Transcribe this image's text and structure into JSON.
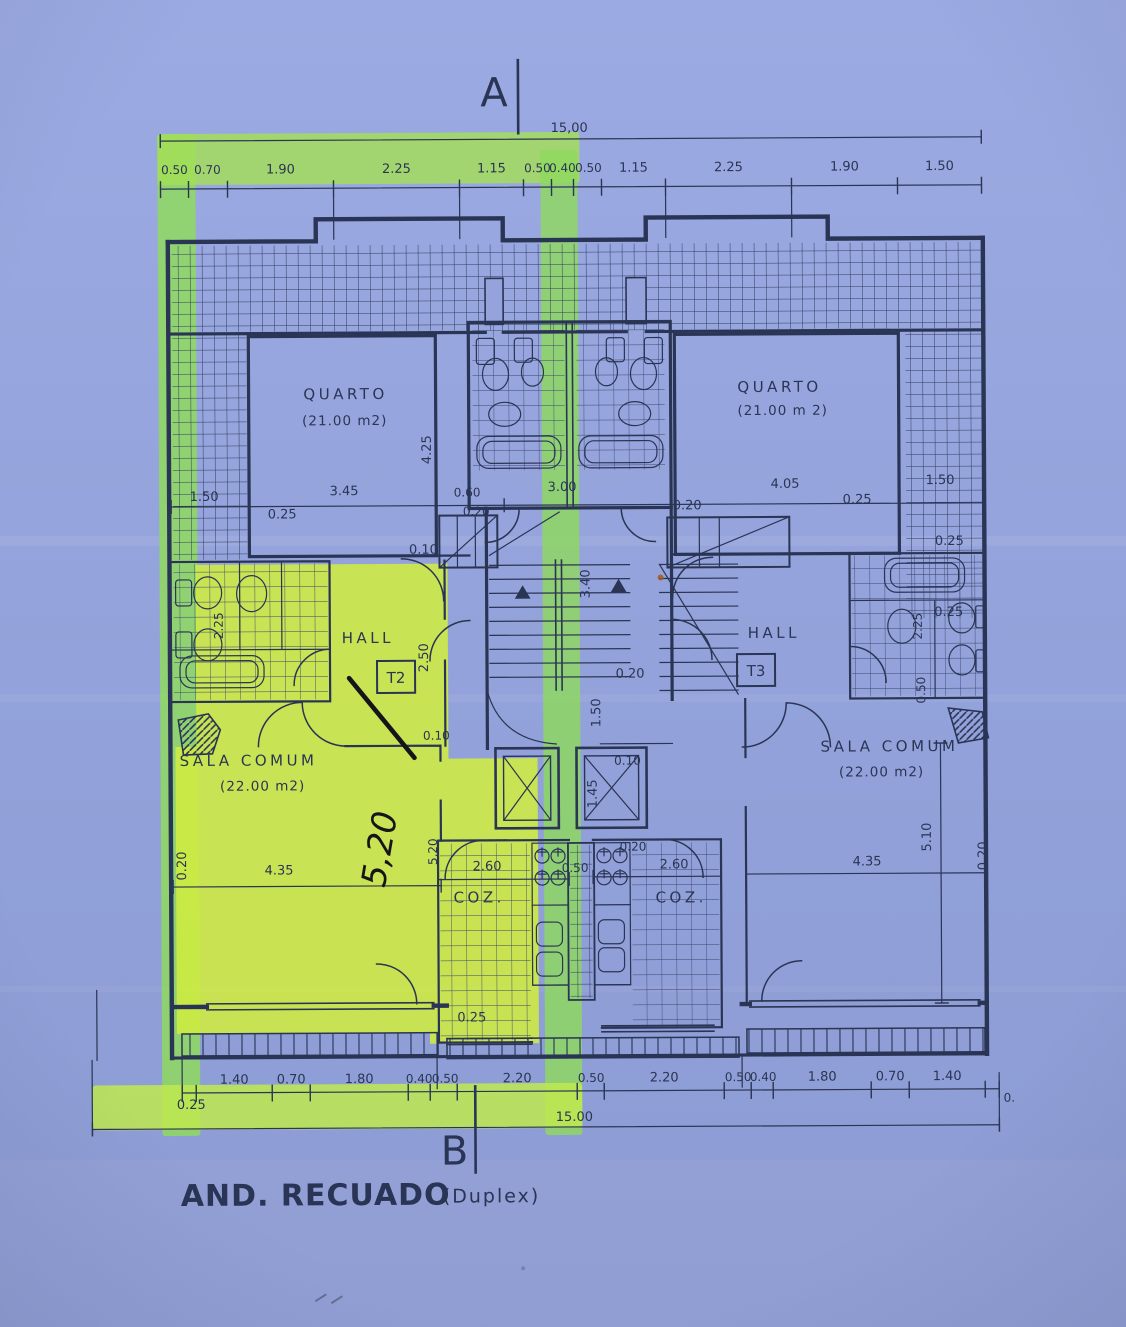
{
  "colors": {
    "paper": "#94a3dc",
    "ink": "#2a3454",
    "pen_black": "#15141b",
    "highlighter_green": "#8fd95e",
    "highlighter_yellow": "#cfec40"
  },
  "markers": {
    "top": "A",
    "bottom": "B"
  },
  "title": {
    "main": "AND. RECUADO",
    "sub": "(Duplex)"
  },
  "overall_dim": {
    "top": "15,00",
    "bottom": "15.00"
  },
  "handwriting": {
    "note": "5,20"
  },
  "rooms": {
    "quarto_left": {
      "name": "QUARTO",
      "area": "(21.00 m2)"
    },
    "quarto_right": {
      "name": "QUARTO",
      "area": "(21.00 m 2)"
    },
    "hall_left": {
      "name": "HALL",
      "tag": "T2"
    },
    "hall_right": {
      "name": "HALL",
      "tag": "T3"
    },
    "sala_left": {
      "name": "SALA COMUM",
      "area": "(22.00 m2)"
    },
    "sala_right": {
      "name": "SALA COMUM",
      "area": "(22.00 m2)"
    },
    "coz_left": {
      "name": "COZ."
    },
    "coz_right": {
      "name": "COZ."
    }
  },
  "dims_top": [
    "0.50",
    "0.70",
    "1.90",
    "2.25",
    "1.15",
    "0.50",
    "0.40",
    "0.50",
    "1.15",
    "2.25",
    "1.90",
    "1.50"
  ],
  "dims_bottom": [
    "1.40",
    "0.70",
    "1.80",
    "0.40",
    "0.50",
    "2.20",
    "0.50",
    "2.20",
    "0.50",
    "0.40",
    "1.80",
    "0.70",
    "1.40"
  ],
  "dims_bottom_left": "0.25",
  "dims_bottom_right": "0.",
  "dims_plan": [
    "1.50",
    "3.45",
    "0.25",
    "0.60",
    "0.20",
    "3.00",
    "0.20",
    "4.05",
    "0.25",
    "1.50",
    "0.25",
    "0.10",
    "4.25",
    "2.50",
    "3.40",
    "0.20",
    "1.50",
    "0.10",
    "0.10",
    "1.45",
    "2.25",
    "2.25",
    "0.50",
    "0.20",
    "4.35",
    "5,20",
    "2.60",
    "0.50",
    "0.20",
    "2.60",
    "4.35",
    "5.10",
    "0.20",
    "0.25",
    "0.25"
  ]
}
